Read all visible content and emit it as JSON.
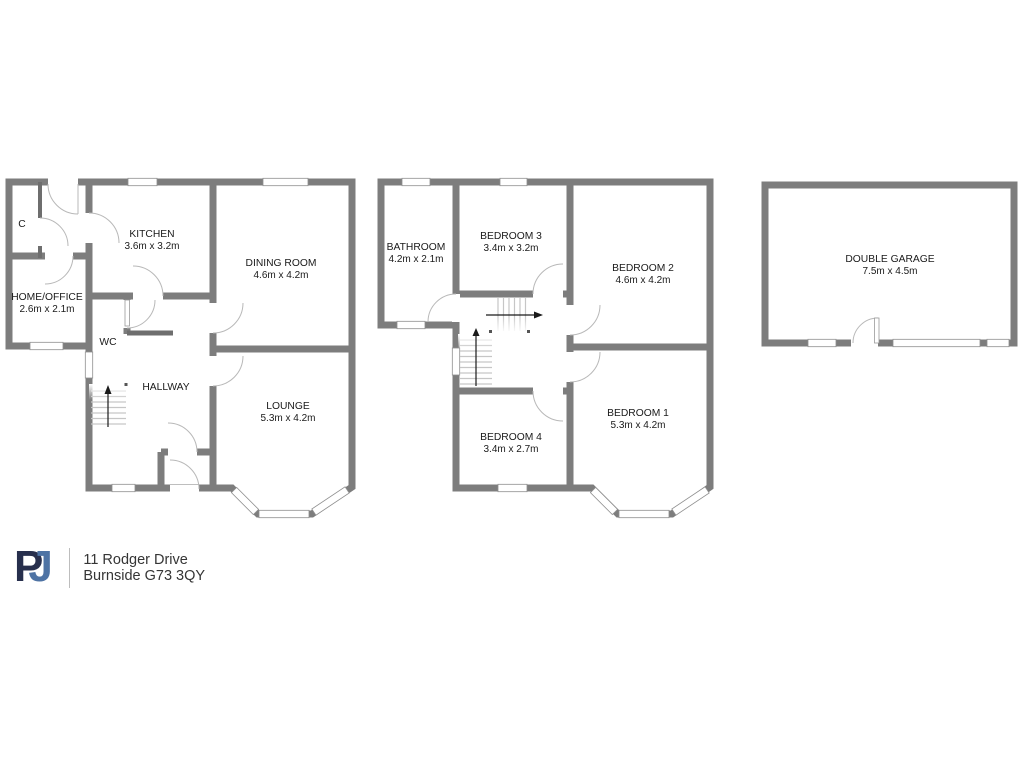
{
  "branding": {
    "logo_letter_p": "P",
    "logo_letter_j": "J",
    "address_line1": "11 Rodger Drive",
    "address_line2": "Burnside G73 3QY"
  },
  "colors": {
    "wall": "#7d7d7d",
    "window_frame": "#8f8f8f",
    "door_arc": "#b8b8b8",
    "logo_p": "#272f4d",
    "logo_j": "#4e73a4",
    "logo_dot": "#ee7d22"
  },
  "floors": {
    "ground": {
      "rooms": {
        "cupboard": {
          "name": "C"
        },
        "kitchen": {
          "name": "KITCHEN",
          "dims": "3.6m x 3.2m"
        },
        "dining": {
          "name": "DINING ROOM",
          "dims": "4.6m x 4.2m"
        },
        "office": {
          "name": "HOME/OFFICE",
          "dims": "2.6m x 2.1m"
        },
        "wc": {
          "name": "WC"
        },
        "hallway": {
          "name": "HALLWAY"
        },
        "lounge": {
          "name": "LOUNGE",
          "dims": "5.3m x 4.2m"
        }
      }
    },
    "first": {
      "rooms": {
        "bathroom": {
          "name": "BATHROOM",
          "dims": "4.2m x 2.1m"
        },
        "bedroom3": {
          "name": "BEDROOM 3",
          "dims": "3.4m x 3.2m"
        },
        "bedroom2": {
          "name": "BEDROOM 2",
          "dims": "4.6m x 4.2m"
        },
        "bedroom4": {
          "name": "BEDROOM 4",
          "dims": "3.4m x 2.7m"
        },
        "bedroom1": {
          "name": "BEDROOM 1",
          "dims": "5.3m x 4.2m"
        }
      }
    },
    "garage": {
      "rooms": {
        "double_garage": {
          "name": "DOUBLE GARAGE",
          "dims": "7.5m x 4.5m"
        }
      }
    }
  }
}
